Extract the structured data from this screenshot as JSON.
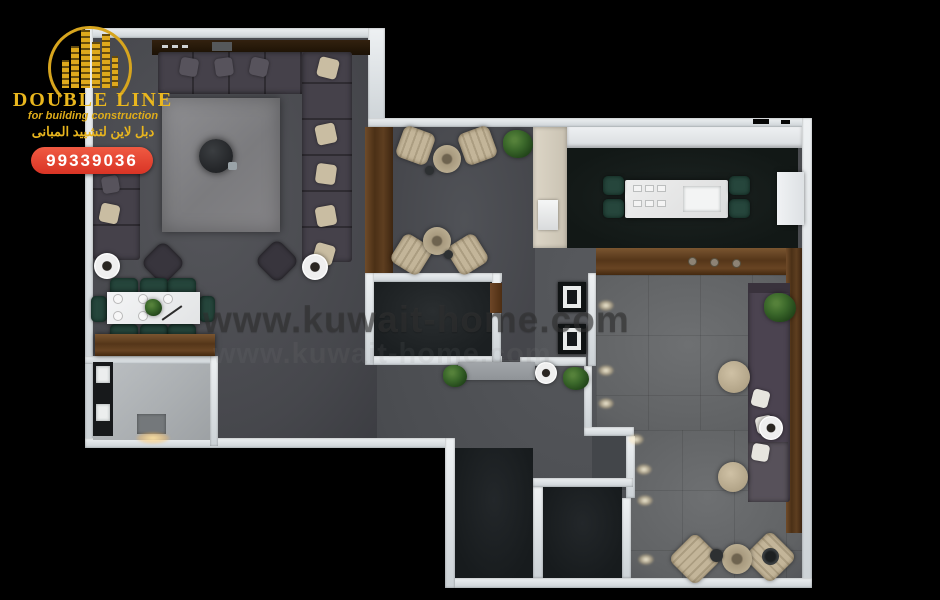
{
  "page": {
    "background": "#000000"
  },
  "branding": {
    "company_name": "DOUBLE LINE",
    "tagline": "for building construction",
    "arabic_name": "دبل لاين لتشييد المبانى",
    "phone": "99339036",
    "logo_icon": "buildings-skyline-icon",
    "colors": {
      "gold": "#e3b322",
      "badge_red": "#e0402c",
      "badge_text": "#ffffff"
    }
  },
  "watermark": {
    "url_text": "www.kuwait-home.com",
    "color": "#3a3a3a"
  },
  "floor_plan": {
    "type": "apartment-top-view-3d-render",
    "rooms": [
      "majlis-living-room",
      "dining-area",
      "bathroom",
      "tea-seating-area",
      "kitchen-dining",
      "hallway",
      "inner-room",
      "bedroom-dark-1",
      "bedroom-dark-2",
      "family-living-room",
      "corridor"
    ]
  }
}
